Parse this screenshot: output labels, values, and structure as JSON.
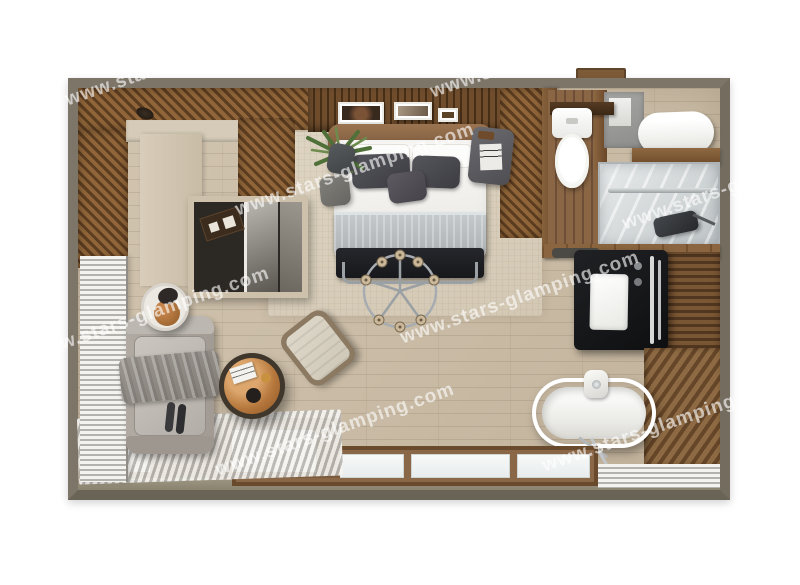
{
  "diagram": {
    "type": "floor-plan",
    "subject": "top-down 3D render of a glamping cabin interior"
  },
  "watermark": {
    "text": "www.stars-glamping.com",
    "color": "rgba(255,255,255,0.62)",
    "instances": 8
  },
  "palette": {
    "page_background": "#ffffff",
    "outer_wall": "#7c7568",
    "wood_wall_dark": "#5d3d20",
    "wood_wall_mid": "#8f6539",
    "wood_floor": "#ccbea9",
    "rug": "#d8cebc",
    "interior_wall_beige": "#d6cbb8",
    "sofa_gray": "#a8a29b",
    "bedding_white": "#f7f6f3",
    "pillow_gray": "#494950",
    "blanket_gray": "#bcc1c4",
    "bench_black": "#1e1f23",
    "vanity_black": "#17181a",
    "copper_accent": "#b5773c",
    "fixture_white": "#ffffff",
    "glass_gray": "#c5cacc",
    "blinds_white": "#f3f2ef",
    "window_frame_brown": "#6a4a2c",
    "plant_green": "#4f7039"
  },
  "elements": [
    "double-bed",
    "headboard",
    "pillows",
    "blanket",
    "foot-bench",
    "swivel-chair",
    "potted-plant",
    "nightstand",
    "wall-art",
    "wardrobe-nook",
    "sofa",
    "throw-blanket",
    "side-table-lamp",
    "copper-coffee-table",
    "lounge-chair",
    "freestanding-bathtub",
    "tub-faucet",
    "black-vanity-sink",
    "toilet",
    "shower-enclosure",
    "towel-roll",
    "venetian-blinds",
    "panorama-windows",
    "wood-deck"
  ]
}
